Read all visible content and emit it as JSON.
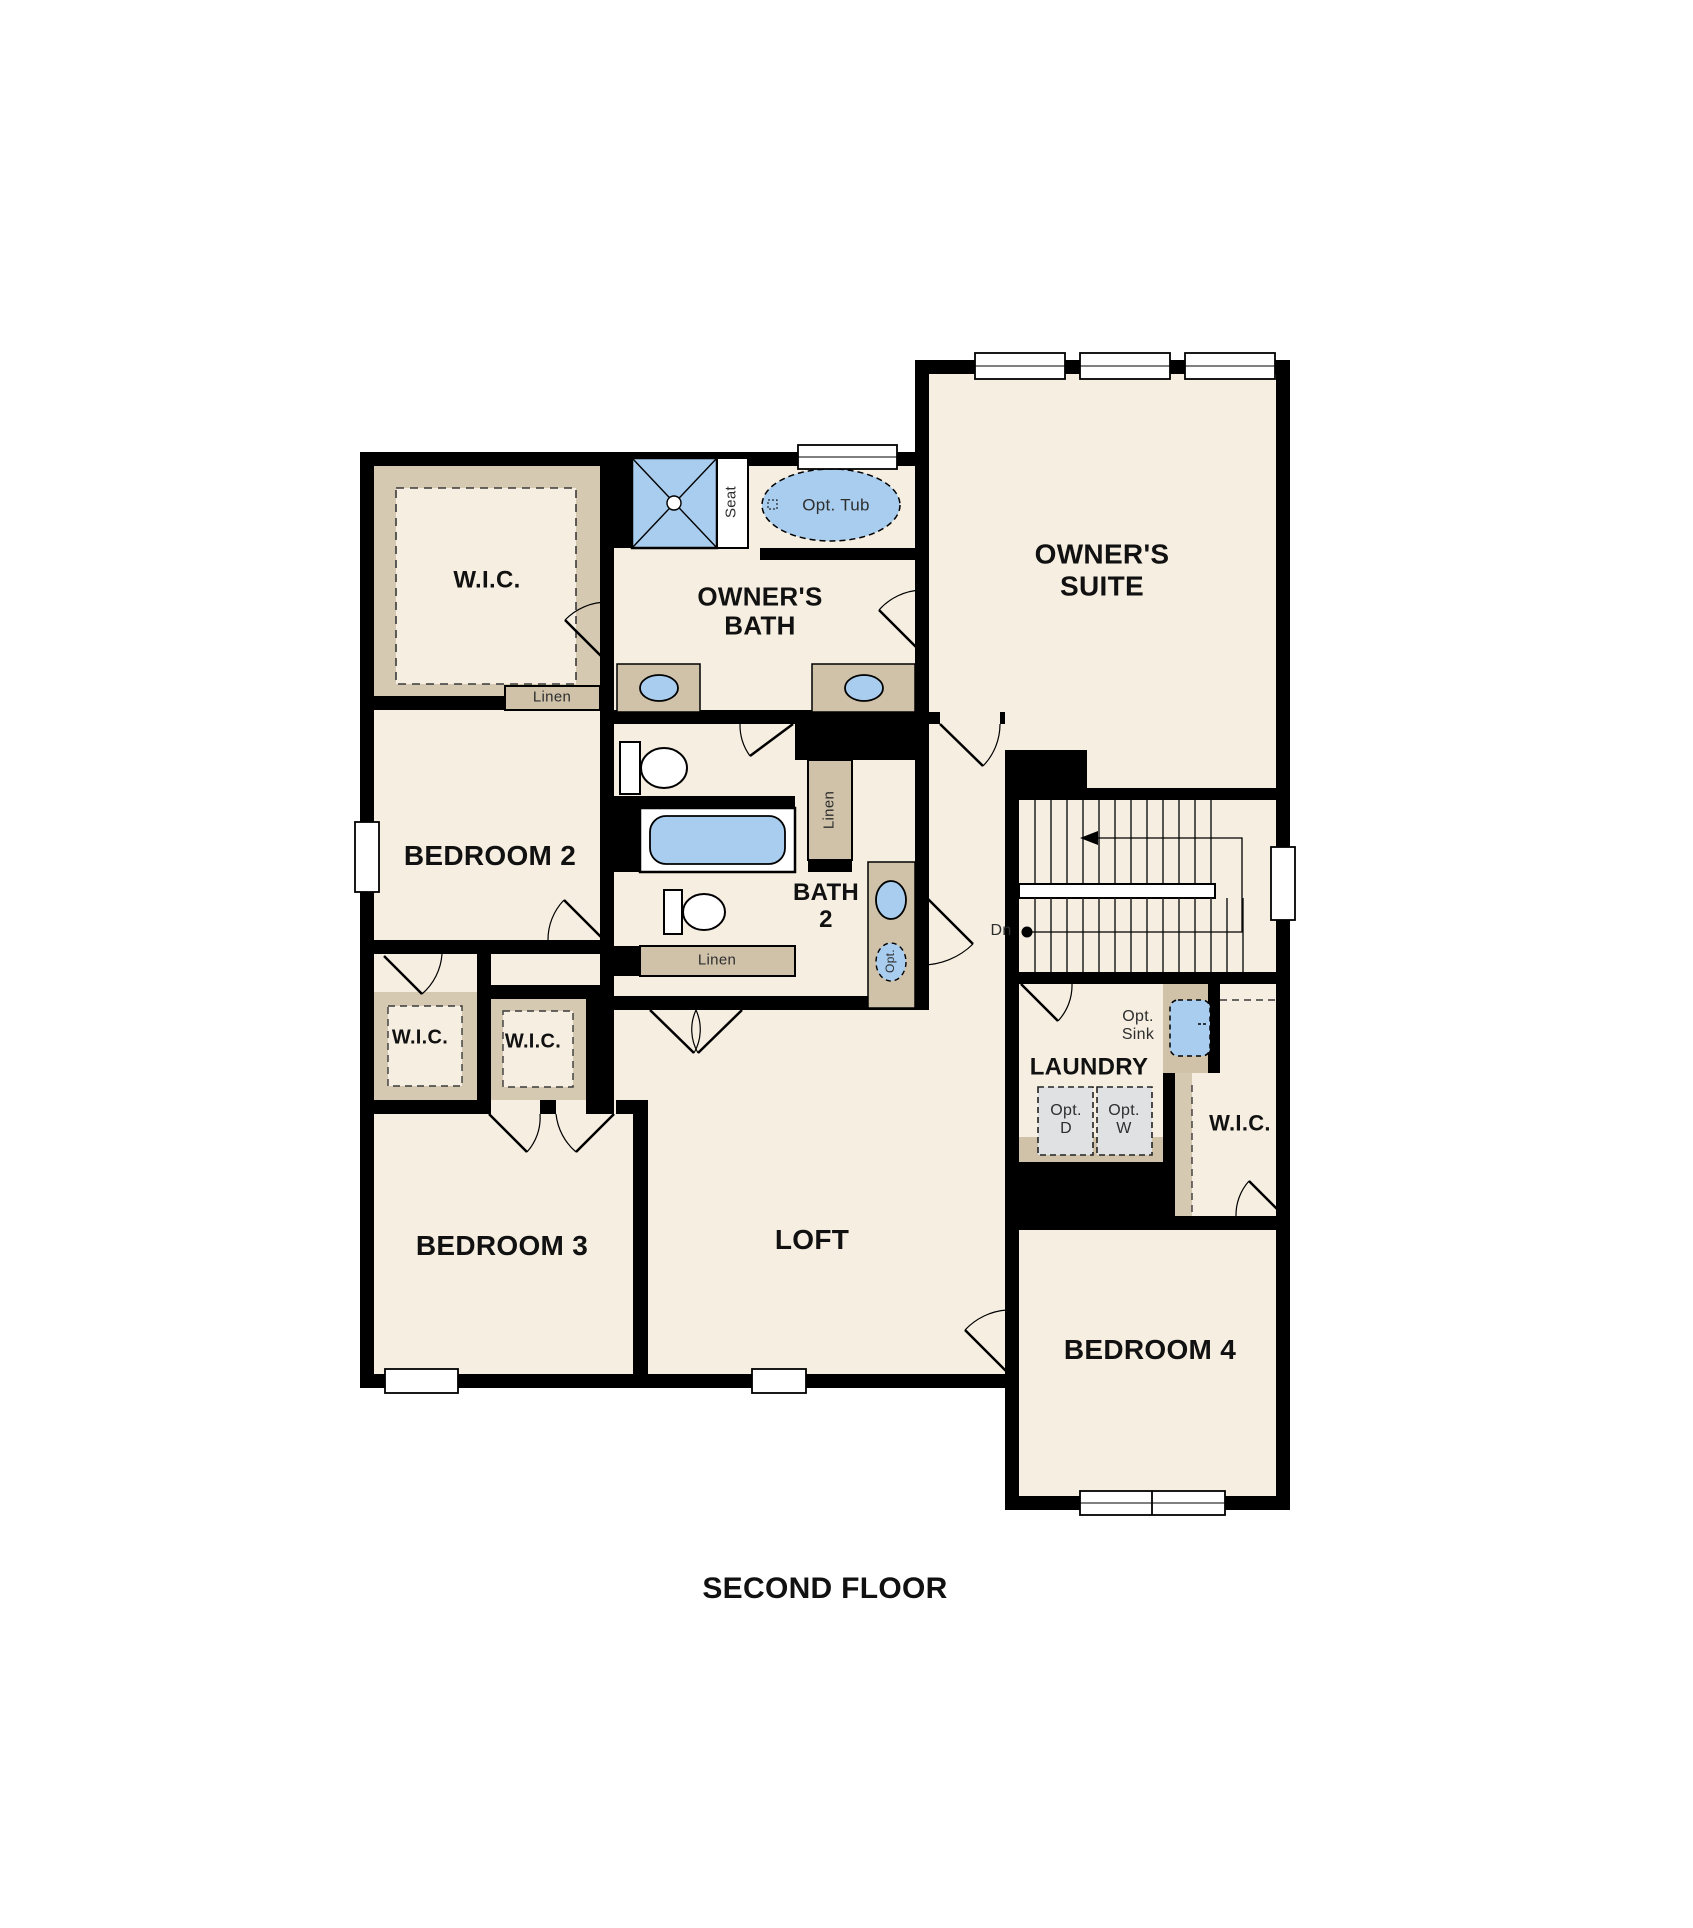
{
  "plan": {
    "floor_label": "SECOND FLOOR",
    "rooms": {
      "owners_suite": {
        "label": "OWNER'S\nSUITE"
      },
      "owners_bath": {
        "label": "OWNER'S\nBATH"
      },
      "wic_owner": {
        "label": "W.I.C."
      },
      "bedroom2": {
        "label": "BEDROOM 2"
      },
      "bath2": {
        "label": "BATH\n2"
      },
      "wic_bedroom2": {
        "label": "W.I.C."
      },
      "wic_bedroom3": {
        "label": "W.I.C."
      },
      "bedroom3": {
        "label": "BEDROOM 3"
      },
      "loft": {
        "label": "LOFT"
      },
      "laundry": {
        "label": "LAUNDRY"
      },
      "wic_bedroom4": {
        "label": "W.I.C."
      },
      "bedroom4": {
        "label": "BEDROOM 4"
      }
    },
    "annotations": {
      "linen_wic": "Linen",
      "linen_hall": "Linen",
      "linen_bath2": "Linen",
      "seat": "Seat",
      "opt_tub": "Opt. Tub",
      "opt_sink_laundry": "Opt.\nSink",
      "opt_sink_bath2": "Opt.",
      "opt_dryer": "Opt.\nD",
      "opt_washer": "Opt.\nW",
      "stairs_down": "Dn"
    },
    "colors": {
      "floor": "#f5eee1",
      "wall": "#000000",
      "casework": "#cfc2a9",
      "wic_band": "#d6c9b1",
      "fixture_blue": "#a9cdee",
      "appliance_gray": "#dfe1e3"
    }
  }
}
